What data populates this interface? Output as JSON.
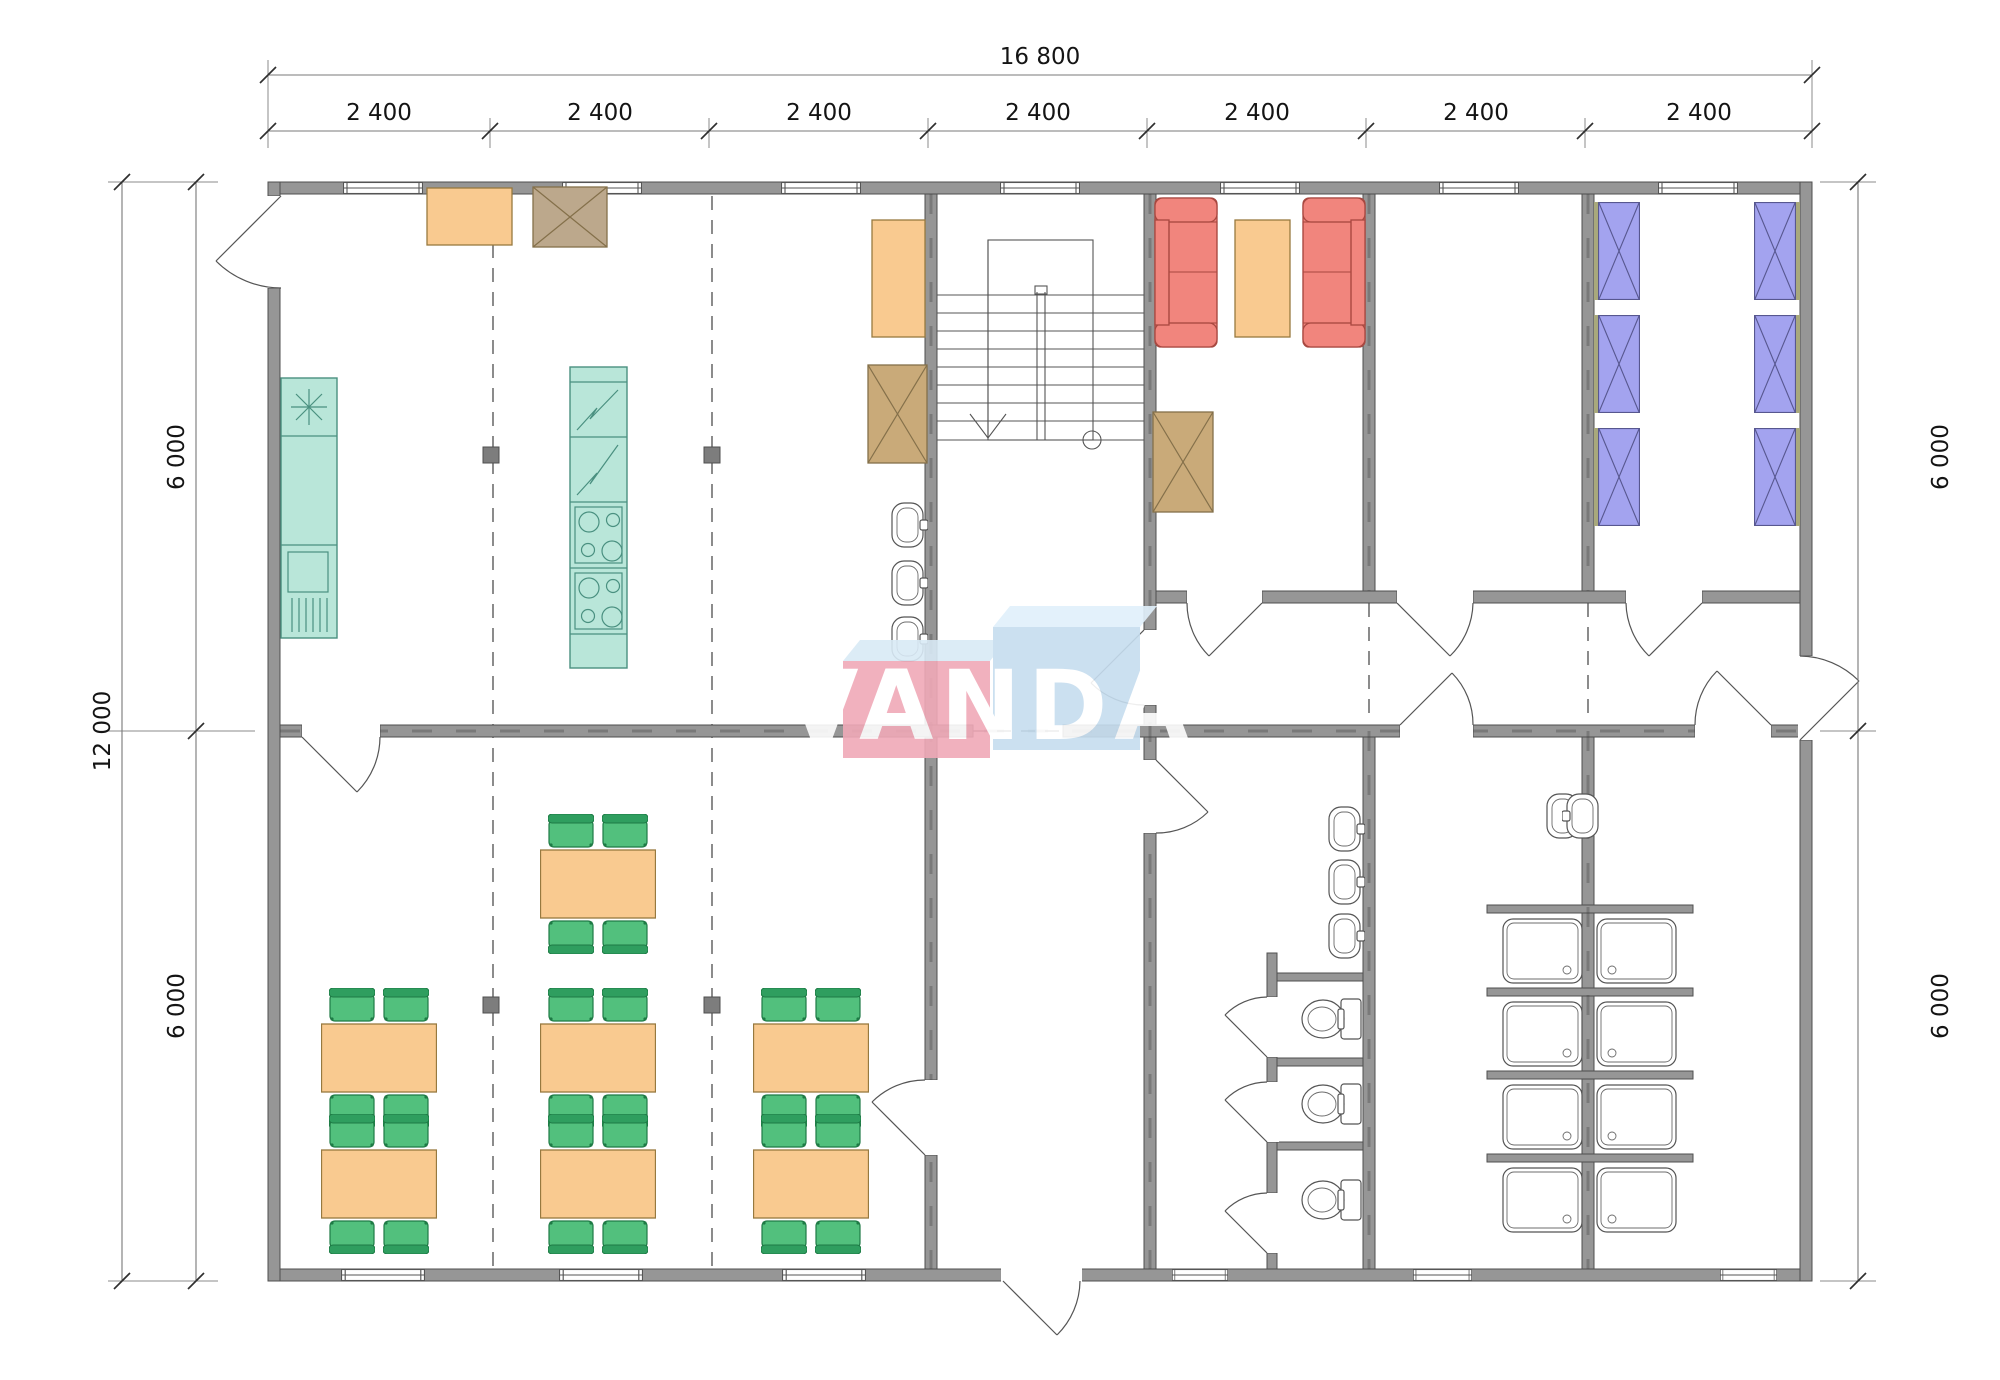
{
  "dimensions": {
    "overall_width": "16 800",
    "bays": [
      "2 400",
      "2 400",
      "2 400",
      "2 400",
      "2 400",
      "2 400",
      "2 400"
    ],
    "overall_height": "12 000",
    "left_segments": [
      "6 000",
      "6 000"
    ],
    "right_segments": [
      "6 000",
      "6 000"
    ]
  },
  "watermark": {
    "text": "VANDA"
  },
  "fixtures": {
    "dining_tables": 7,
    "chairs": 28,
    "beds": 6,
    "sofas": 2,
    "coffee_tables": 1,
    "wardrobes": 4,
    "stoves": 2,
    "fridges": 2,
    "washbasins": 8,
    "toilets": 3,
    "showers": 8,
    "stairs": 1
  },
  "colors": {
    "wall": "#969696",
    "wall_stroke": "#4f4f4f",
    "line": "#555555",
    "teal": "#b9e6d9",
    "teal_stroke": "#4a9080",
    "orange": "#f9ca90",
    "orange_stroke": "#97793f",
    "green": "#52c07d",
    "green_stroke": "#1e7a45",
    "green_back": "#2f9e5f",
    "red": "#f1857d",
    "red_stroke": "#a84840",
    "blue": "#a3a3ef",
    "blue_stroke": "#57578f",
    "bed_strip": "#a8a87c",
    "tan": "#c9aa79",
    "tan2": "#bca88c",
    "tan_stroke": "#84704a",
    "logo_pink": "#f0a9b8",
    "logo_blue": "#c6ddef",
    "logo_topA": "#d9eaf6",
    "logo_topB": "#e0f0fb",
    "logo_text": "#ffffff"
  }
}
